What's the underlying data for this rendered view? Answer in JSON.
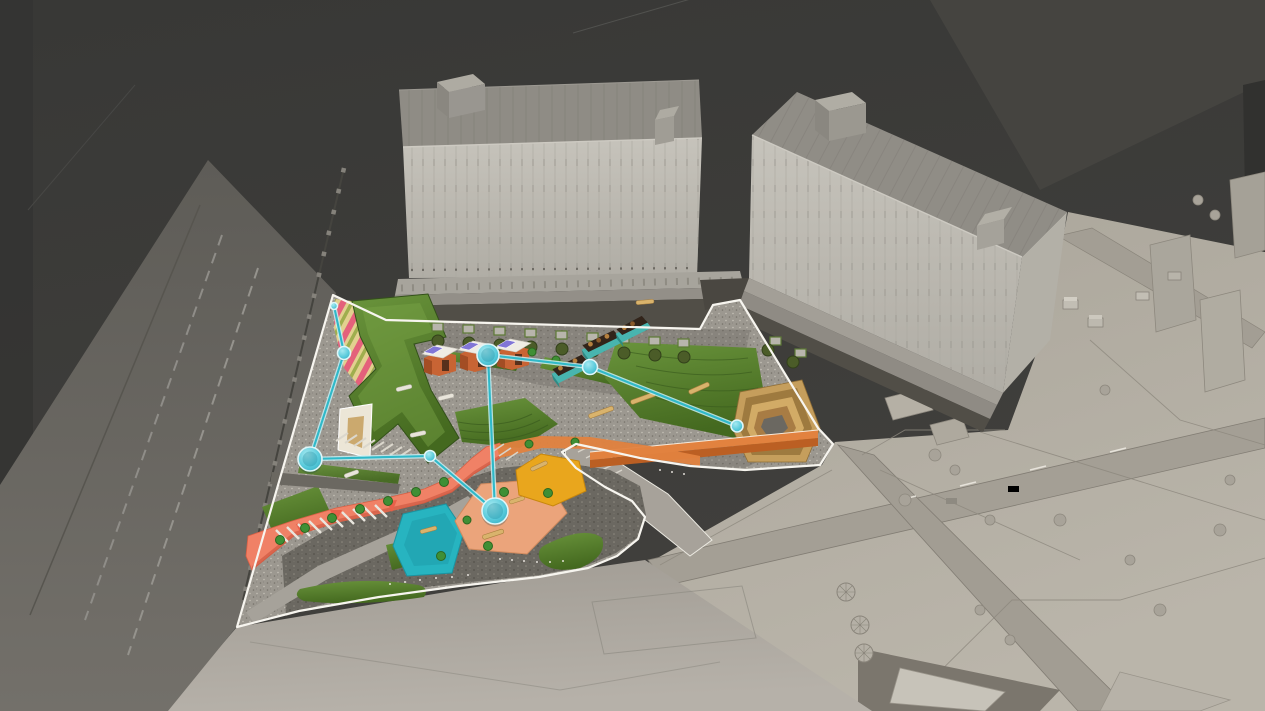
{
  "scene": {
    "kind": "architectural-3d-masterplan-render",
    "description": "Aerial axonometric render of a landscape plaza design between two grey building slabs, with clay-model urban context at right, streets at left, and a cyan program-connection network overlay on the colored site plan.",
    "inventory": {
      "buildings": 2,
      "market_stalls": 3,
      "teal_kiosks": 3,
      "activity_decks": [
        "teal-playground",
        "peach-plaza",
        "yellow-deck"
      ],
      "connection_nodes": 8,
      "connection_links": 7
    }
  },
  "colors": {
    "backdrop_dark": "#3b3b38",
    "backdrop_light": "#454440",
    "road_asphalt": "#6e6c67",
    "road_marking": "#9a9791",
    "plaza_ground": "#a9a49c",
    "clay_ground": "#b2ada2",
    "clay_line": "#8a857b",
    "building_facade": "#c0bdb5",
    "building_roof": "#8f8c85",
    "building_podium": "#a29f97",
    "arcade_dark": "#514e47",
    "paving_light": "#9c9890",
    "paving_mid": "#86827b",
    "paving_dark": "#6b6861",
    "site_outline": "#f7f5ef",
    "lawn": "#4f7c2a",
    "lawn_light": "#6a943c",
    "lawn_dark": "#3a5c1e",
    "coral": "#f08166",
    "coral_dark": "#d95f44",
    "orange": "#e2823f",
    "orange_dark": "#bb5f23",
    "ramp_base": "#e2d08f",
    "ramp_stripe": "#e4617b",
    "ramp_stripe2": "#9fae4e",
    "sand": "#ece6d7",
    "sand_inner": "#c8a263",
    "wood": "#c59e5c",
    "wood_dark": "#9e7a3f",
    "stall_brick": "#c86434",
    "stall_brick_dark": "#a34d24",
    "stall_roof": "#efece4",
    "stall_panel": "#8176d6",
    "kiosk_teal": "#48b5af",
    "kiosk_teal_dark": "#2c8c86",
    "kiosk_roof": "#32241a",
    "deck_teal": "#27b4c0",
    "deck_peach": "#eba47b",
    "deck_yellow": "#e9a61d",
    "bench": "#d9b36c",
    "shrub": "#3f8f35",
    "tree_olive": "#4b5c28",
    "net_line": "#2fb9c9",
    "net_halo": "#c8f0f4",
    "net_rim": "#dff6f8"
  },
  "overlay_network": {
    "nodes": [
      {
        "id": "site-corner",
        "x": 334,
        "y": 306,
        "r": 3.5
      },
      {
        "id": "ramp-garden",
        "x": 344,
        "y": 353,
        "r": 6.5
      },
      {
        "id": "west-entry",
        "x": 310,
        "y": 459,
        "r": 12
      },
      {
        "id": "mid-path",
        "x": 430,
        "y": 456,
        "r": 5.5
      },
      {
        "id": "market-stalls",
        "x": 488,
        "y": 355,
        "r": 11
      },
      {
        "id": "kiosk-row",
        "x": 590,
        "y": 367,
        "r": 7.5
      },
      {
        "id": "east-terraces",
        "x": 737,
        "y": 426,
        "r": 6
      },
      {
        "id": "central-plaza",
        "x": 495,
        "y": 511,
        "r": 13
      }
    ],
    "links": [
      [
        "site-corner",
        "ramp-garden"
      ],
      [
        "ramp-garden",
        "west-entry"
      ],
      [
        "west-entry",
        "mid-path"
      ],
      [
        "mid-path",
        "central-plaza"
      ],
      [
        "central-plaza",
        "market-stalls"
      ],
      [
        "market-stalls",
        "kiosk-row"
      ],
      [
        "kiosk-row",
        "east-terraces"
      ]
    ]
  }
}
